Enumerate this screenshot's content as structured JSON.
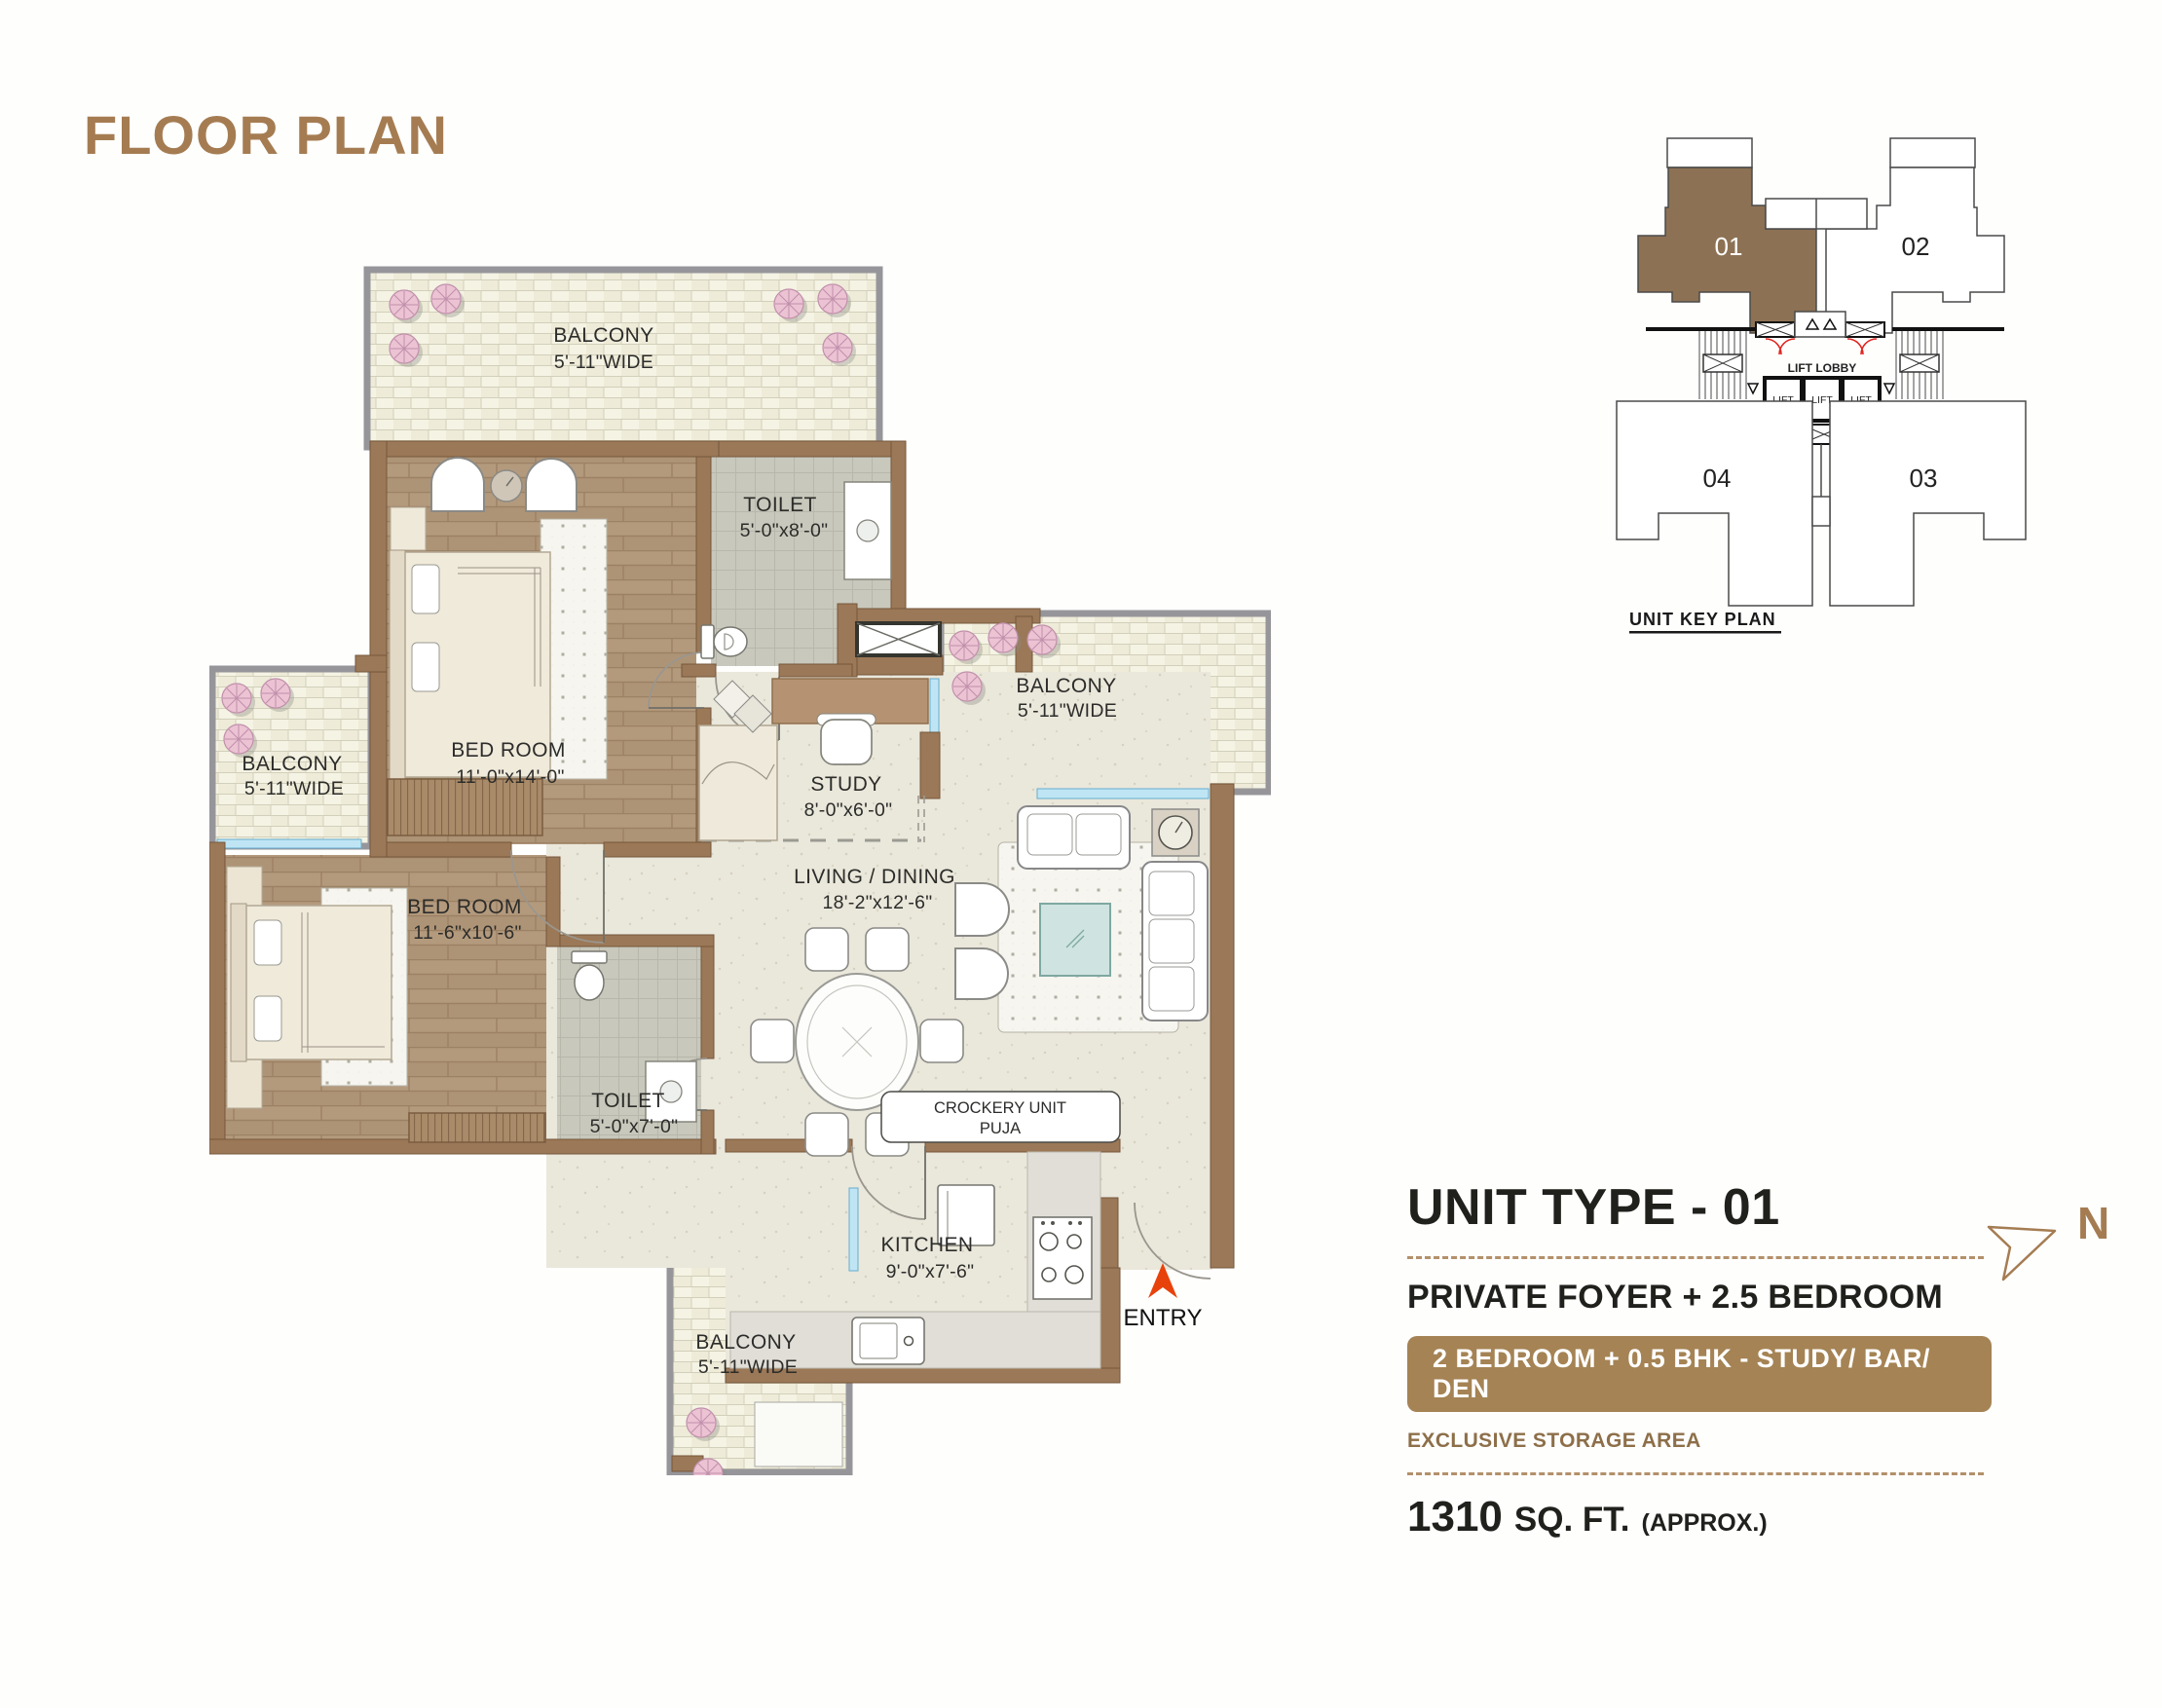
{
  "header": {
    "title": "FLOOR PLAN"
  },
  "plan": {
    "balcony_top": {
      "name": "BALCONY",
      "dims": "5'-11\"WIDE"
    },
    "toilet_1": {
      "name": "TOILET",
      "dims": "5'-0\"x8'-0\""
    },
    "bedroom_1": {
      "name": "BED ROOM",
      "dims": "11'-0\"x14'-0\""
    },
    "balcony_left": {
      "name": "BALCONY",
      "dims": "5'-11\"WIDE"
    },
    "bedroom_2": {
      "name": "BED ROOM",
      "dims": "11'-6\"x10'-6\""
    },
    "study": {
      "name": "STUDY",
      "dims": "8'-0\"x6'-0\""
    },
    "living_dining": {
      "name": "LIVING / DINING",
      "dims": "18'-2\"x12'-6\""
    },
    "balcony_right": {
      "name": "BALCONY",
      "dims": "5'-11\"WIDE"
    },
    "toilet_2": {
      "name": "TOILET",
      "dims": "5'-0\"x7'-0\""
    },
    "kitchen": {
      "name": "KITCHEN",
      "dims": "9'-0\"x7'-6\""
    },
    "balcony_bottom": {
      "name": "BALCONY",
      "dims": "5'-11\"WIDE"
    },
    "crockery_line1": "CROCKERY UNIT",
    "crockery_line2": "PUJA",
    "entry": "ENTRY"
  },
  "key_plan": {
    "units": {
      "u01": "01",
      "u02": "02",
      "u03": "03",
      "u04": "04"
    },
    "lift_lobby": "LIFT LOBBY",
    "lifts": [
      "LIFT",
      "LIFT",
      "LIFT"
    ],
    "caption": "UNIT KEY PLAN"
  },
  "details": {
    "unit_type": "UNIT TYPE - 01",
    "subtitle": "PRIVATE FOYER + 2.5 BEDROOM",
    "badge": "2 BEDROOM + 0.5 BHK - STUDY/ BAR/ DEN",
    "storage_note": "EXCLUSIVE STORAGE AREA",
    "area_value": "1310",
    "area_unit": "SQ. FT.",
    "area_approx": "(APPROX.)",
    "north_label": "N"
  },
  "colors": {
    "accent": "#a57c52",
    "wall": "#9b7857",
    "unit_highlight": "#8d7154",
    "badge_bg": "#a58354",
    "entry_arrow": "#e8420c"
  }
}
